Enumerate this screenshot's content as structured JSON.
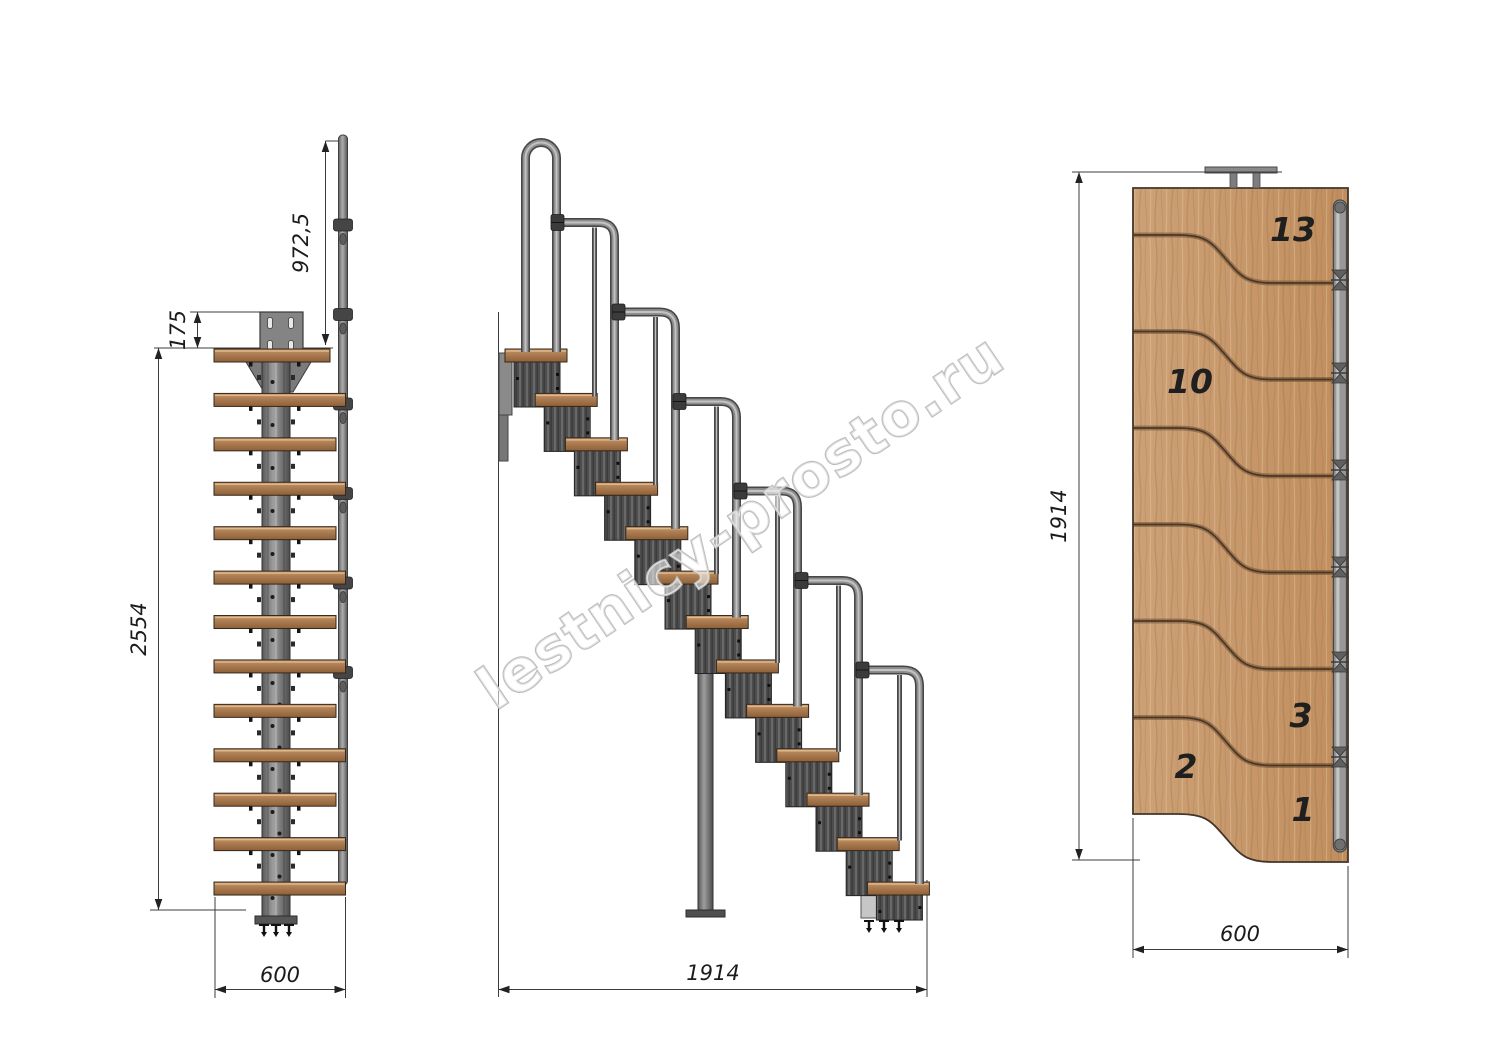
{
  "watermark": {
    "text": "lestnicy-prosto.ru"
  },
  "front_view": {
    "dim_handrail_height": "972,5",
    "dim_plate_offset": "175",
    "dim_total_height": "2554",
    "dim_width": "600",
    "step_count": 13
  },
  "side_view": {
    "dim_run": "1914",
    "step_count": 13
  },
  "plan_view": {
    "dim_run": "1914",
    "dim_width": "600",
    "step_numbers": [
      "13",
      "10",
      "3",
      "2",
      "1"
    ]
  },
  "colors": {
    "wood_plan": "#c89a6e",
    "wood_tread": "#aa7b50",
    "metal": "#8f8f8f",
    "metal_dark": "#474747",
    "dimension": "#3c3c3c",
    "watermark_stroke": "#bdbdbd"
  }
}
